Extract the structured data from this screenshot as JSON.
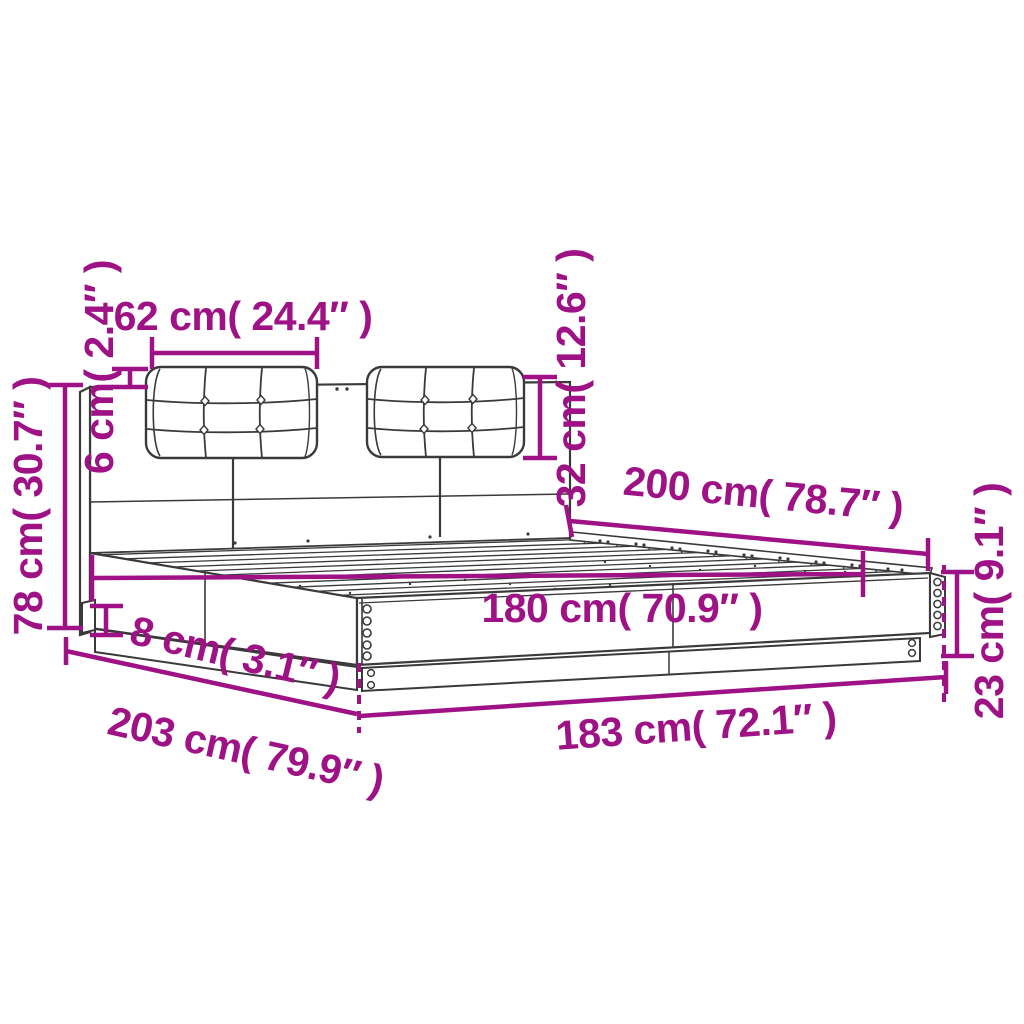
{
  "figure": {
    "kind": "product-dimension-diagram",
    "subject": "bed frame with headboard and two tufted cushions, perspective line drawing",
    "background_color": "#ffffff",
    "ink_color": "#3a3a3a",
    "accent_color": "#9e1285"
  },
  "dims": {
    "cushion_width": "62 cm( 24.4″ )",
    "cushion_depth": "6 cm( 2.4″ )",
    "headboard_height": "78 cm( 30.7″ )",
    "cushion_height": "32 cm( 12.6″ )",
    "inner_length": "200 cm( 78.7″ )",
    "inner_width": "180 cm( 70.9″ )",
    "frame_height": "23 cm( 9.1″ )",
    "base_height": "8 cm( 3.1″ )",
    "outer_length": "203 cm( 79.9″ )",
    "outer_width": "183 cm( 72.1″ )"
  }
}
